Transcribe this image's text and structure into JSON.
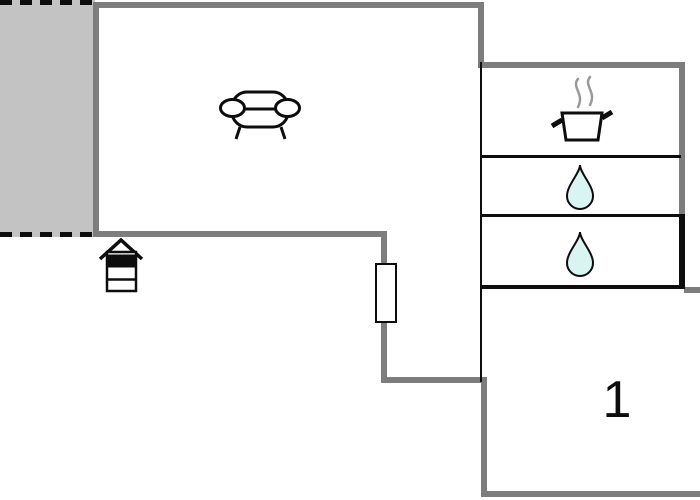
{
  "title": "Floor plan",
  "colors": {
    "background": "#ffffff",
    "wall_gray": "#7d7d7d",
    "terrace_fill": "#c3c3c3",
    "line_black": "#0d0d0d",
    "drop_fill": "#d9f4f1",
    "steam_gray": "#999999"
  },
  "rooms": {
    "terrace": {
      "icon": "none",
      "border_style": "dashed"
    },
    "living_room": {
      "icon": "sofa-icon"
    },
    "kitchen": {
      "icon": "cooking-pot-icon"
    },
    "bathroom_top": {
      "icon": "water-drop-icon"
    },
    "bathroom_bottom": {
      "icon": "water-drop-icon"
    },
    "bedroom": {
      "label": "1"
    }
  },
  "symbols": {
    "fireplace": "fireplace-icon",
    "door": "door-icon"
  }
}
